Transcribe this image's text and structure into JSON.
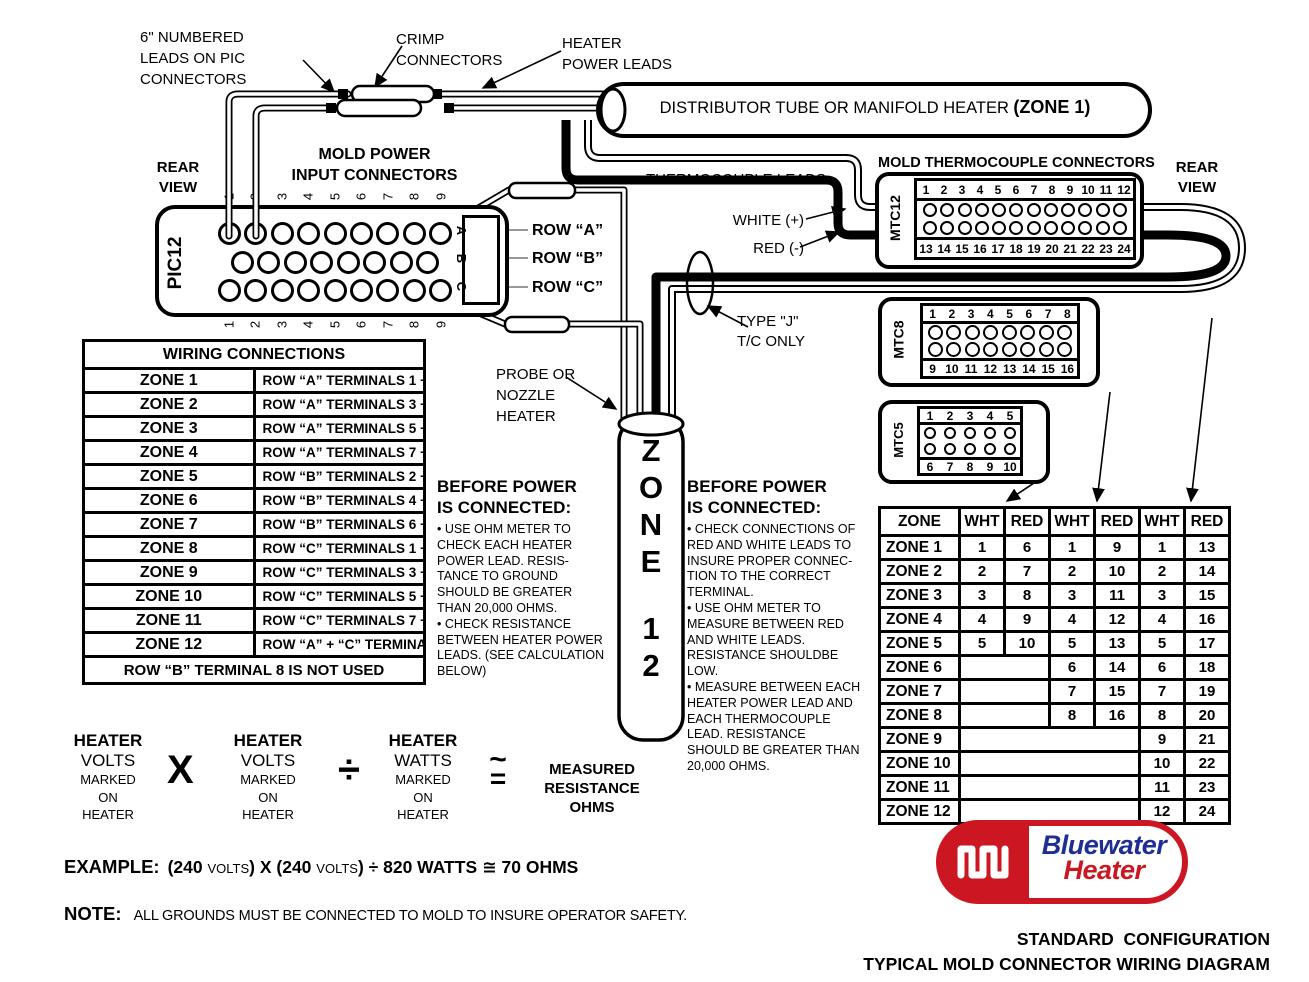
{
  "labels": {
    "numbered_leads": "6\" NUMBERED\nLEADS ON PIC\nCONNECTORS",
    "crimp": "CRIMP\nCONNECTORS",
    "heater_power_leads": "HEATER\nPOWER LEADS",
    "distributor_text": "DISTRIBUTOR TUBE OR MANIFOLD HEATER",
    "distributor_zone": "(ZONE 1)",
    "rear_view_left": "REAR\nVIEW",
    "mold_power": "MOLD POWER\nINPUT CONNECTORS",
    "thermocouple_leads": "THERMOCOUPLE LEADS",
    "white_plus": "WHITE (+)",
    "red_minus": "RED (-)",
    "mold_tc_connectors": "MOLD THERMOCOUPLE CONNECTORS",
    "rear_view_right": "REAR\nVIEW",
    "row_a": "ROW “A”",
    "row_b": "ROW “B”",
    "row_c": "ROW “C”",
    "type_j": "TYPE \"J\"\nT/C ONLY",
    "probe": "PROBE OR\nNOZZLE\nHEATER"
  },
  "connectors": {
    "pic12": {
      "name": "PIC12",
      "top_numbers": [
        "1",
        "2",
        "3",
        "4",
        "5",
        "6",
        "7",
        "8",
        "9"
      ],
      "bottom_numbers": [
        "1",
        "2",
        "3",
        "4",
        "5",
        "6",
        "7",
        "8",
        "9"
      ],
      "row_letters": [
        "A",
        "B",
        "C"
      ],
      "row_hole_counts": [
        9,
        8,
        9
      ]
    },
    "mtc12": {
      "name": "MTC12",
      "top_numbers": [
        "1",
        "2",
        "3",
        "4",
        "5",
        "6",
        "7",
        "8",
        "9",
        "10",
        "11",
        "12"
      ],
      "bottom_numbers": [
        "13",
        "14",
        "15",
        "16",
        "17",
        "18",
        "19",
        "20",
        "21",
        "22",
        "23",
        "24"
      ],
      "hole_rows": [
        12,
        12
      ]
    },
    "mtc8": {
      "name": "MTC8",
      "top_numbers": [
        "1",
        "2",
        "3",
        "4",
        "5",
        "6",
        "7",
        "8"
      ],
      "bottom_numbers": [
        "9",
        "10",
        "11",
        "12",
        "13",
        "14",
        "15",
        "16"
      ],
      "hole_rows": [
        8,
        8
      ]
    },
    "mtc5": {
      "name": "MTC5",
      "top_numbers": [
        "1",
        "2",
        "3",
        "4",
        "5"
      ],
      "bottom_numbers": [
        "6",
        "7",
        "8",
        "9",
        "10"
      ],
      "hole_rows": [
        5,
        5
      ]
    }
  },
  "zone_heater": {
    "label": "ZONE 12"
  },
  "wiring_table": {
    "title": "WIRING CONNECTIONS",
    "rows": [
      [
        "ZONE 1",
        "ROW “A” TERMINALS 1 + 2"
      ],
      [
        "ZONE 2",
        "ROW “A” TERMINALS 3 + 4"
      ],
      [
        "ZONE 3",
        "ROW “A” TERMINALS 5 + 6"
      ],
      [
        "ZONE 4",
        "ROW “A” TERMINALS 7 + 8"
      ],
      [
        "ZONE 5",
        "ROW “B” TERMINALS 2 + 3"
      ],
      [
        "ZONE 6",
        "ROW “B” TERMINALS 4 + 5"
      ],
      [
        "ZONE 7",
        "ROW “B” TERMINALS 6 + 7"
      ],
      [
        "ZONE 8",
        "ROW “C” TERMINALS 1 + 2"
      ],
      [
        "ZONE 9",
        "ROW “C” TERMINALS 3 + 4"
      ],
      [
        "ZONE 10",
        "ROW “C” TERMINALS 5 + 6"
      ],
      [
        "ZONE 11",
        "ROW “C” TERMINALS 7 + 8"
      ],
      [
        "ZONE 12",
        "ROW “A” + “C” TERMINALS 9"
      ]
    ],
    "footer": "ROW “B” TERMINAL 8 IS NOT USED"
  },
  "before_left": {
    "title": "BEFORE POWER\nIS CONNECTED:",
    "items": [
      "• USE OHM METER TO\nCHECK EACH HEATER\nPOWER LEAD.  RESIS-\nTANCE TO GROUND\nSHOULD BE GREATER\nTHAN 20,000 OHMS.",
      "• CHECK RESISTANCE\nBETWEEN HEATER POWER\nLEADS. (SEE CALCULATION\nBELOW)"
    ]
  },
  "before_right": {
    "title": "BEFORE POWER\nIS CONNECTED:",
    "items": [
      "• CHECK CONNECTIONS OF\nRED AND WHITE LEADS TO\nINSURE PROPER CONNEC-\nTION TO THE CORRECT\nTERMINAL.",
      "• USE OHM METER TO\nMEASURE BETWEEN RED\nAND WHITE LEADS.\nRESISTANCE SHOULDBE\nLOW.",
      "• MEASURE BETWEEN EACH\nHEATER POWER LEAD AND\nEACH THERMOCOUPLE\nLEAD.  RESISTANCE\nSHOULD BE GREATER THAN\n20,000 OHMS."
    ]
  },
  "zone_table": {
    "headers": [
      "ZONE",
      "WHT",
      "RED",
      "WHT",
      "RED",
      "WHT",
      "RED"
    ],
    "rows": [
      {
        "zone": "ZONE 1",
        "cells": [
          "1",
          "6",
          "1",
          "9",
          "1",
          "13"
        ]
      },
      {
        "zone": "ZONE 2",
        "cells": [
          "2",
          "7",
          "2",
          "10",
          "2",
          "14"
        ]
      },
      {
        "zone": "ZONE 3",
        "cells": [
          "3",
          "8",
          "3",
          "11",
          "3",
          "15"
        ]
      },
      {
        "zone": "ZONE 4",
        "cells": [
          "4",
          "9",
          "4",
          "12",
          "4",
          "16"
        ]
      },
      {
        "zone": "ZONE 5",
        "cells": [
          "5",
          "10",
          "5",
          "13",
          "5",
          "17"
        ]
      },
      {
        "zone": "ZONE 6",
        "cells": [
          null,
          null,
          "6",
          "14",
          "6",
          "18"
        ]
      },
      {
        "zone": "ZONE 7",
        "cells": [
          null,
          null,
          "7",
          "15",
          "7",
          "19"
        ]
      },
      {
        "zone": "ZONE 8",
        "cells": [
          null,
          null,
          "8",
          "16",
          "8",
          "20"
        ]
      },
      {
        "zone": "ZONE 9",
        "cells": [
          null,
          null,
          null,
          null,
          "9",
          "21"
        ]
      },
      {
        "zone": "ZONE 10",
        "cells": [
          null,
          null,
          null,
          null,
          "10",
          "22"
        ]
      },
      {
        "zone": "ZONE 11",
        "cells": [
          null,
          null,
          null,
          null,
          "11",
          "23"
        ]
      },
      {
        "zone": "ZONE 12",
        "cells": [
          null,
          null,
          null,
          null,
          "12",
          "24"
        ]
      }
    ]
  },
  "formula": {
    "terms": [
      {
        "line1": "HEATER",
        "line2": "VOLTS",
        "line3": "MARKED\nON\nHEATER"
      },
      {
        "line1": "HEATER",
        "line2": "VOLTS",
        "line3": "MARKED\nON\nHEATER"
      },
      {
        "line1": "HEATER",
        "line2": "WATTS",
        "line3": "MARKED\nON\nHEATER"
      }
    ],
    "op1": "X",
    "op2": "÷",
    "approx_top": "~",
    "approx_bottom": "=",
    "result": "MEASURED\nRESISTANCE\nOHMS"
  },
  "example": {
    "label": "EXAMPLE:",
    "segments": [
      {
        "t": "(240 ",
        "small": false
      },
      {
        "t": "VOLTS",
        "small": true
      },
      {
        "t": ") X (240 ",
        "small": false
      },
      {
        "t": "VOLTS",
        "small": true
      },
      {
        "t": ") ÷ 820 WATTS ≅ 70 OHMS",
        "small": false
      }
    ]
  },
  "note": {
    "label": "NOTE:",
    "text": "ALL GROUNDS MUST BE CONNECTED TO MOLD TO INSURE OPERATOR SAFETY."
  },
  "logo": {
    "word1": "Bluewater",
    "word2": "Heater",
    "red": "#cc1722",
    "blue": "#1f2e95"
  },
  "footer": {
    "line1": "STANDARD  CONFIGURATION",
    "line2": "TYPICAL MOLD CONNECTOR WIRING DIAGRAM"
  }
}
